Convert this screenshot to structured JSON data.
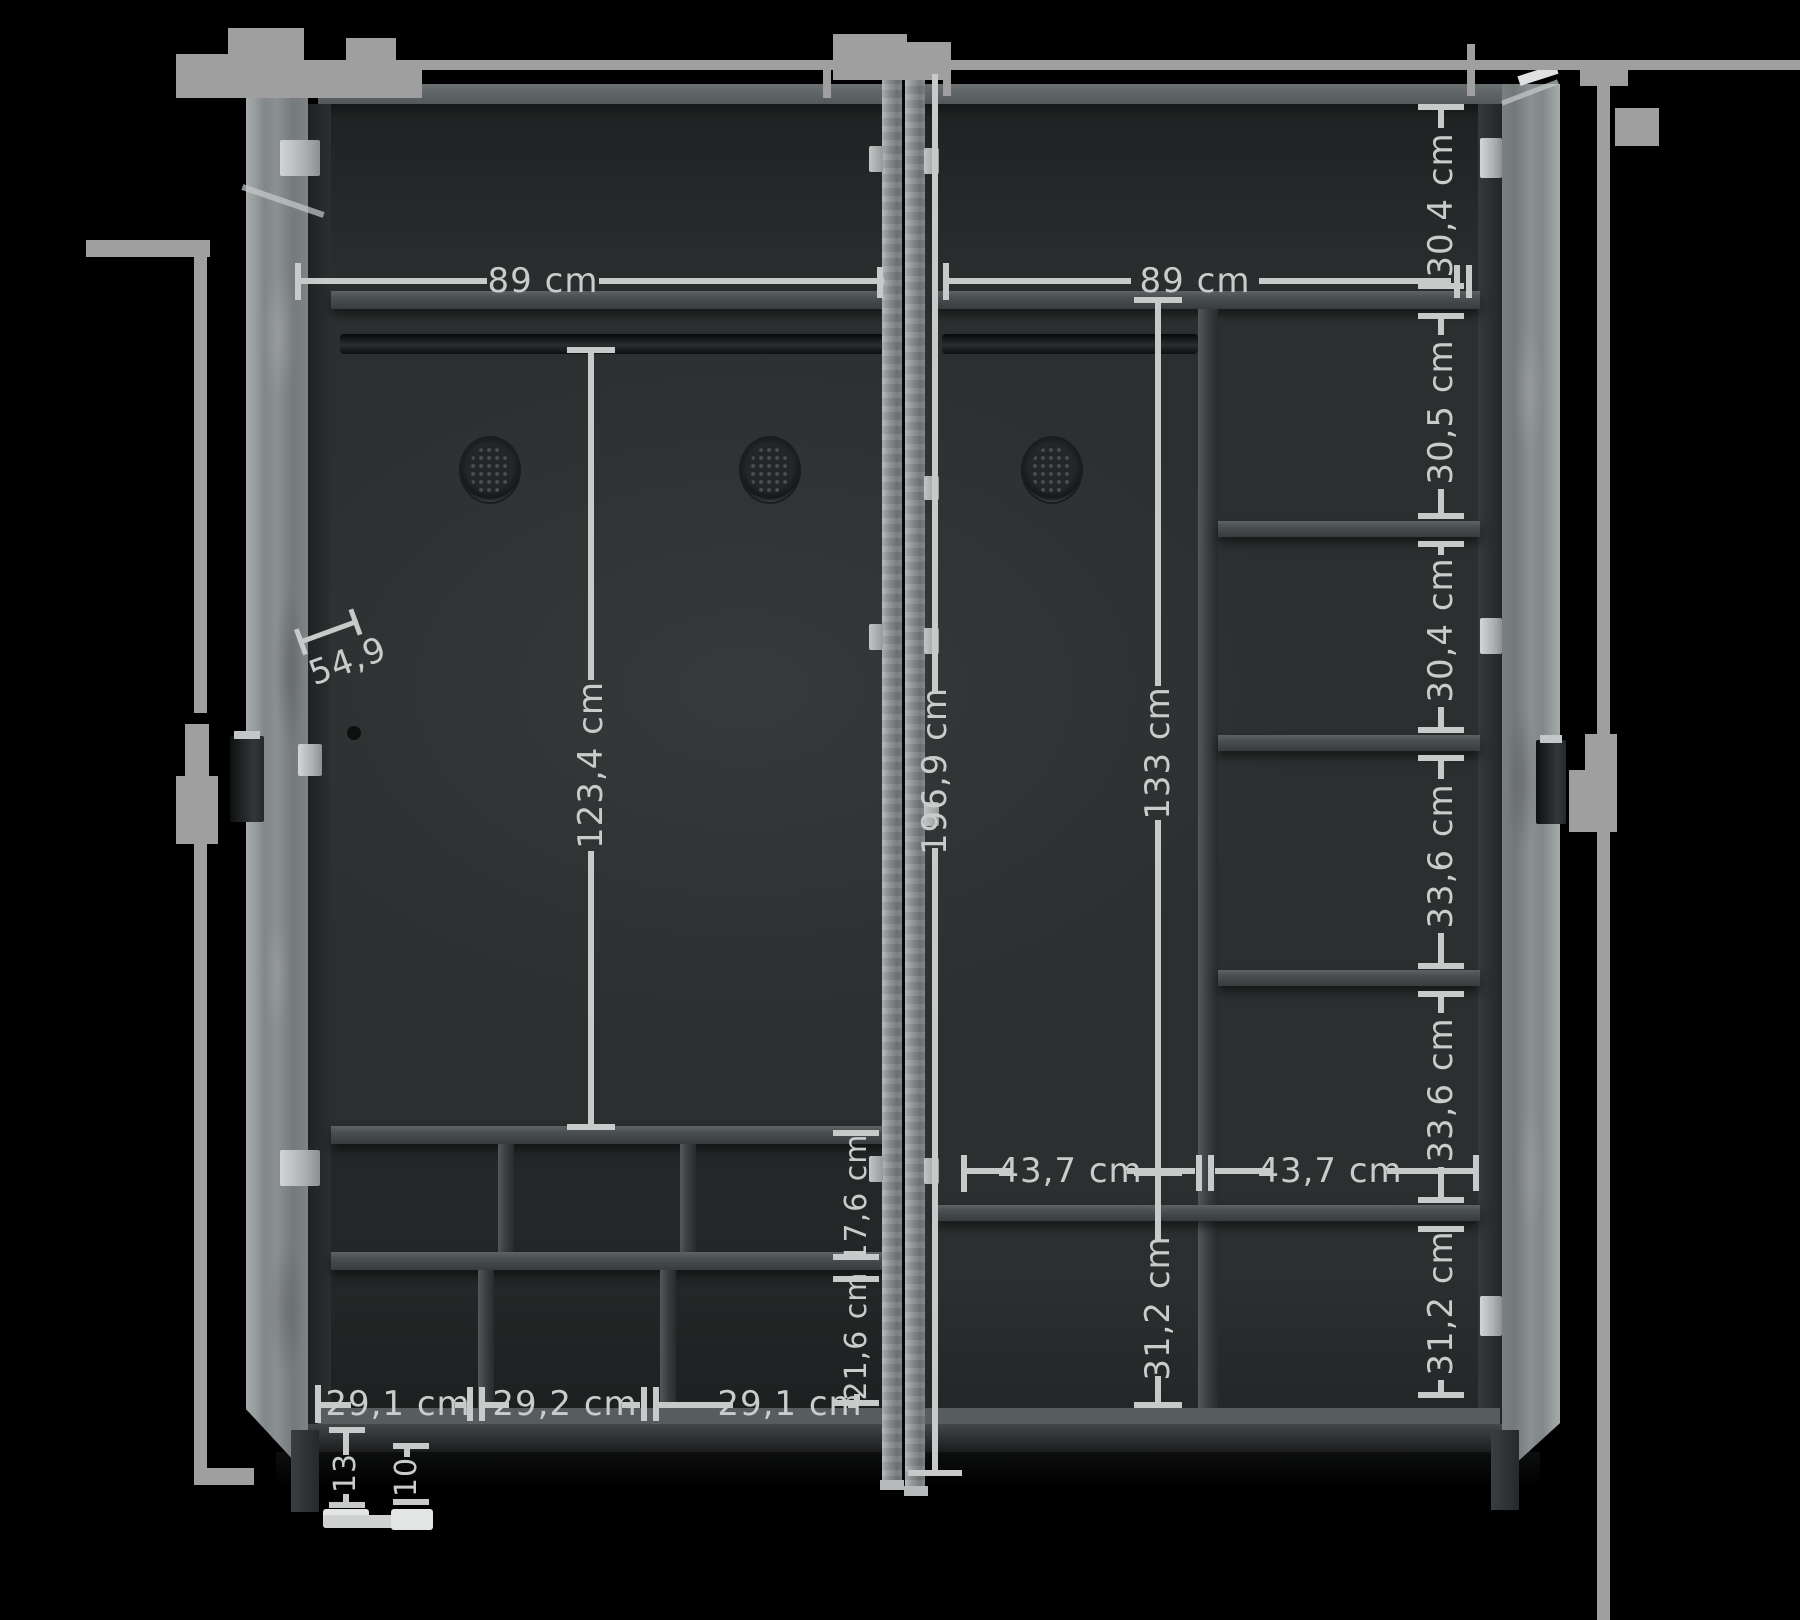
{
  "diagram": {
    "subject": "wardrobe interior dimensions",
    "background_color": "#000000",
    "dimension_line_color": "#c7cac9",
    "outer_line_color": "#9f9f9f"
  },
  "dims": {
    "left_section_width": "89 cm",
    "right_section_width": "89 cm",
    "right_shelf_gap_1": "30,4 cm",
    "right_shelf_gap_2": "30,5 cm",
    "right_shelf_gap_3": "30,4 cm",
    "right_shelf_gap_4": "33,6 cm",
    "right_shelf_gap_5": "33,6 cm",
    "right_shelf_gap_6": "31,2 cm",
    "left_hanging_height": "123,4 cm",
    "interior_height": "196,9 cm",
    "right_hanging_height": "133 cm",
    "interior_depth": "54,9",
    "left_cubby_row1_height": "17,6 cm",
    "left_cubby_row2_height": "21,6 cm",
    "left_cubby_width_1": "29,1 cm",
    "left_cubby_width_2": "29,2 cm",
    "left_cubby_width_3": "29,1 cm",
    "right_cell_width_1": "43,7 cm",
    "right_cell_width_2": "43,7 cm",
    "right_mid_bottom_height": "31,2 cm",
    "plinth_clearance": "13",
    "leg_height": "10"
  }
}
